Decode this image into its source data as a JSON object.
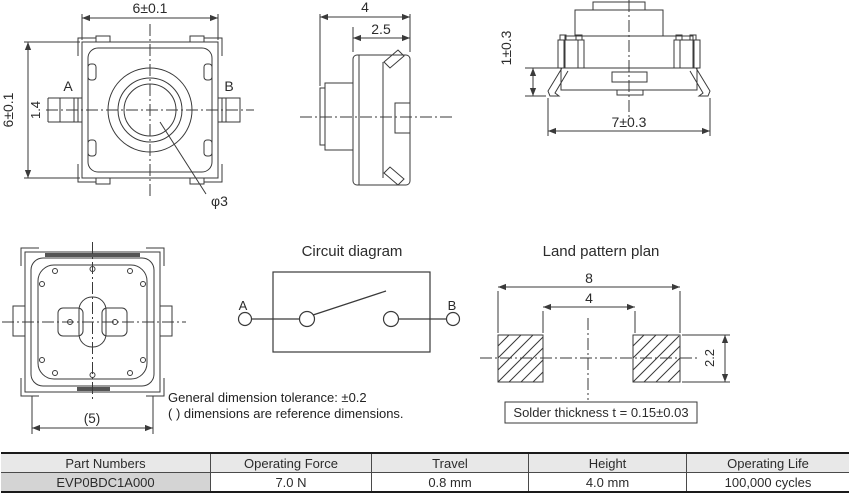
{
  "drawing": {
    "top_view": {
      "dim_width": "6±0.1",
      "dim_height": "6±0.1",
      "dim_terminal": "1.4",
      "dim_plunger": "φ3",
      "label_a": "A",
      "label_b": "B"
    },
    "side_view": {
      "dim_depth": "4",
      "dim_body_depth": "2.5"
    },
    "front_view": {
      "dim_terminal_height": "1±0.3",
      "dim_lead_span": "7±0.3"
    },
    "bottom_view": {
      "dim_width_ref": "(5)"
    },
    "circuit": {
      "title": "Circuit diagram",
      "label_a": "A",
      "label_b": "B"
    },
    "land_pattern": {
      "title": "Land pattern plan",
      "dim_outer": "8",
      "dim_inner": "4",
      "dim_pad_height": "2.2",
      "solder_note": "Solder thickness t = 0.15±0.03"
    },
    "notes": {
      "line1": "General dimension tolerance: ±0.2",
      "line2": "( ) dimensions are reference dimensions."
    }
  },
  "table": {
    "headers": [
      "Part Numbers",
      "Operating Force",
      "Travel",
      "Height",
      "Operating Life"
    ],
    "rows": [
      [
        "EVP0BDC1A000",
        "7.0 N",
        "0.8 mm",
        "4.0 mm",
        "100,000 cycles"
      ]
    ]
  },
  "colors": {
    "line": "#3a3a3a",
    "header_bg": "#e8e8e8",
    "part_cell_bg": "#d4d4d4"
  }
}
